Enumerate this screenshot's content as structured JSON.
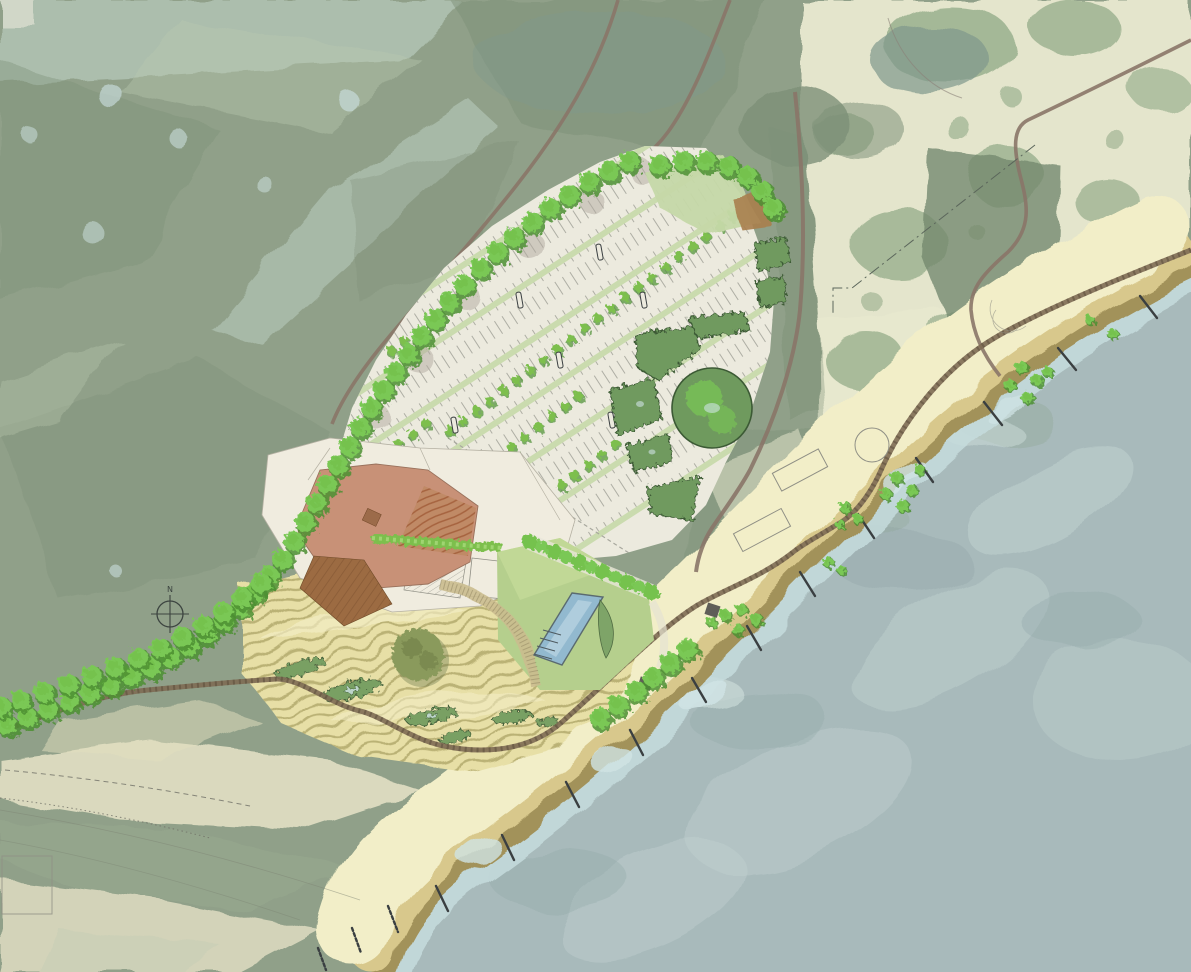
{
  "map": {
    "type": "landscape-master-plan",
    "compass": {
      "label": "N"
    },
    "features": [
      "hillside",
      "coastal-field",
      "hill-roads",
      "parking-lot",
      "tree-allee",
      "parking-medians",
      "drop-off-circle",
      "entrance-green",
      "mulch-bed",
      "visitor-building-roof",
      "amphitheater-roof",
      "timber-deck",
      "pergola",
      "hedge-row",
      "event-lawn",
      "swimming-pool",
      "vine-trellis",
      "dune-garden",
      "bioswales",
      "specimen-tree",
      "gravel-coast-road",
      "beach-dry-sand",
      "beach-wet-sand",
      "shallow-water",
      "groynes",
      "ocean",
      "shrub-clusters",
      "existing-structure-outlines",
      "north-arrow"
    ]
  },
  "palette": {
    "hillside_base": "#90a089",
    "hillside_dark": "#7d9078",
    "hillside_darker": "#74896f",
    "hillside_light": "#b9c8b0",
    "aqua_patch": "#c7dbd2",
    "pale_blue": "#cfe3e4",
    "field_cream": "#e9e9d0",
    "field_green": "#8fa885",
    "forest_teal": "#7f988c",
    "road_brown": "#8a7668",
    "gravel_path": "#7e6c54",
    "gravel_dot": "#574a38",
    "pavement": "#eceade",
    "pavement_line": "#a8a89e",
    "plaza": "#f0ecdf",
    "plaza_edge": "#b5b1a3",
    "median_green": "#c6d9a8",
    "lawn_light": "#cde2a0",
    "hedge_green": "#7dbf4e",
    "hedge_light": "#a4d878",
    "tree_bright": "#74c24e",
    "tree_mid": "#7ac855",
    "tree_dark": "#4c8f33",
    "island_green": "#6f9a5e",
    "island_edge": "#3c5a35",
    "roof_salmon": "#c89177",
    "roof_base": "#c08a66",
    "roof_stripe": "#a35f3b",
    "roof_edge": "#99715c",
    "skylight_brown": "#9c6b4a",
    "deck_brown": "#9c6b42",
    "deck_stripe": "#7a4f2e",
    "lawn_green": "#b5cf8d",
    "pool_blue": "#92b9cf",
    "pool_light": "#bcd6e2",
    "pool_edge": "#5a6a70",
    "dune_sand": "#e7dfa6",
    "dune_stripe": "#b0a76b",
    "dune_crest": "#f4eec6",
    "swale_green": "#79a064",
    "swale_edge": "#44603a",
    "olive_tree": "#8a9a5b",
    "olive_dark": "#6e7c45",
    "sand_light": "#f2eec8",
    "sand_mid": "#d8c88c",
    "sand_wet": "#a2925a",
    "shallow_blue": "#c6dcdd",
    "water": "#a8babb",
    "water_light": "#c2d3d1",
    "water_dark": "#93a8a9",
    "foam": "#d8e8e4",
    "groyne_dark": "#3a3f41",
    "outline_gray": "#8f8f85",
    "mulch_brown": "#a97f4e",
    "gravel_band": "#cbbd8f",
    "hut_dark": "#5f5e58",
    "understory_gray": "#b3aba1",
    "compass_ink": "#3c4440",
    "contour_line": "#7d8474",
    "trail_dash": "#6f6f66",
    "property_line": "#5b665b"
  }
}
